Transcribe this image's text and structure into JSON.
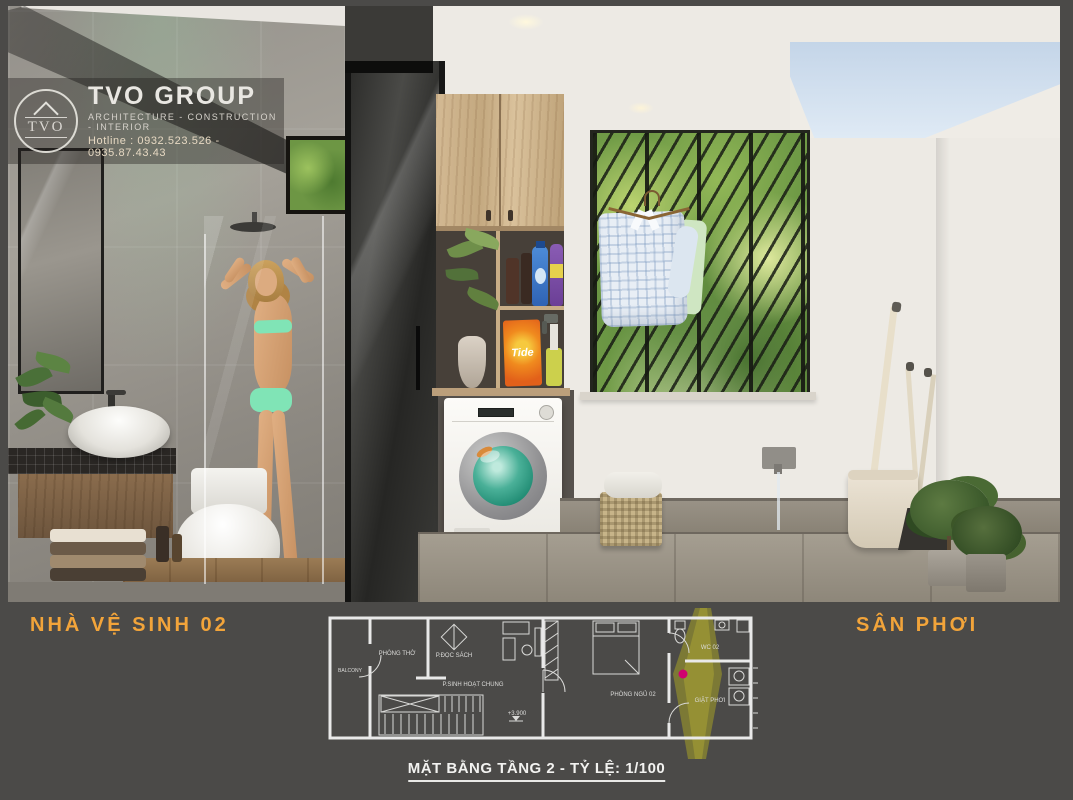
{
  "logo": {
    "badge": "TVO",
    "company": "TVO GROUP",
    "tagline": "ARCHITECTURE - CONSTRUCTION - INTERIOR",
    "hotline": "Hotline : 0932.523.526 - 0935.87.43.43"
  },
  "labels": {
    "bathroom": "NHÀ VỆ SINH 02",
    "drying_yard": "SÂN PHƠI"
  },
  "floor_plan": {
    "rooms": {
      "balcony": "BALCONY",
      "worship": "PHÒNG THỜ",
      "reading": "P.ĐỌC SÁCH",
      "common": "P.SINH HOẠT CHUNG",
      "bedroom": "PHÒNG NGỦ 02",
      "wc": "WC 02",
      "laundry": "GIẶT PHƠI"
    },
    "level_mark": "+3.900",
    "caption": "MẶT BẰNG TẦNG 2 - TỶ LỆ: 1/100"
  },
  "scene": {
    "detergent_brand": "Tide"
  },
  "colors": {
    "band_background": "#4B4A48",
    "accent_orange": "#F2A43A",
    "plan_lines": "#E9E9E9",
    "highlight_beam": "#BDB725",
    "location_marker": "#D0006F",
    "washer_glass_teal": "#2FA98E"
  }
}
